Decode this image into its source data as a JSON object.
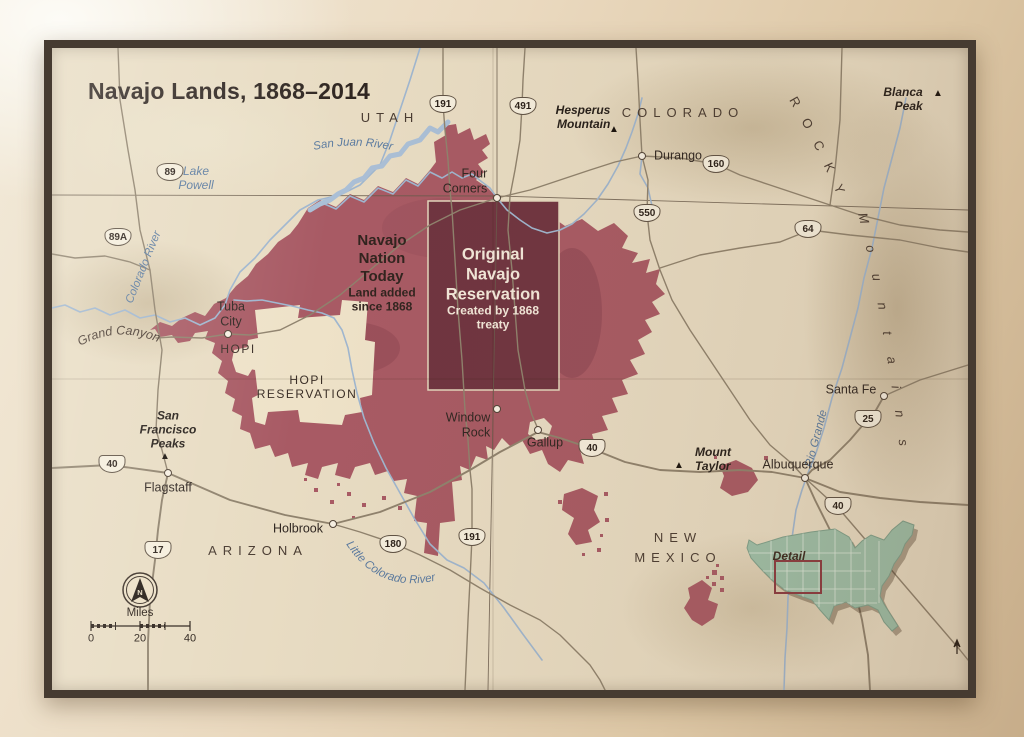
{
  "title": "Navajo Lands, 1868–2014",
  "legend": {
    "nation_title": "Navajo\nNation\nToday",
    "nation_sub": "Land added\nsince 1868",
    "original_title": "Original\nNavajo\nReservation",
    "original_sub": "Created by 1868\ntreaty"
  },
  "states": {
    "utah": "UTAH",
    "colorado": "COLORADO",
    "arizona": "ARIZONA",
    "new_mexico": "NEW\nMEXICO",
    "rocky": "ROCKY",
    "mountains": "Mountains"
  },
  "cities": {
    "four_corners": "Four\nCorners",
    "durango": "Durango",
    "tuba_city": "Tuba\nCity",
    "window_rock": "Window\nRock",
    "gallup": "Gallup",
    "holbrook": "Holbrook",
    "flagstaff": "Flagstaff",
    "albuquerque": "Albuquerque",
    "santa_fe": "Santa Fe"
  },
  "peaks": {
    "hesperus": "Hesperus\nMountain",
    "blanca": "Blanca\nPeak",
    "san_francisco": "San\nFrancisco\nPeaks",
    "mount_taylor": "Mount\nTaylor"
  },
  "water": {
    "lake_powell": "Lake\nPowell",
    "san_juan_river": "San Juan River",
    "colorado_river": "Colorado River",
    "little_colorado_river": "Little Colorado River",
    "rio_grande": "Rio Grande",
    "grand_canyon": "Grand Canyon"
  },
  "areas": {
    "hopi": "HOPI",
    "hopi_reservation": "HOPI\nRESERVATION"
  },
  "routes": {
    "us89": "89",
    "us89a": "89A",
    "us191_n": "191",
    "us491": "491",
    "us160": "160",
    "us550": "550",
    "us64": "64",
    "i25": "25",
    "i40_w": "40",
    "i40_c": "40",
    "i40_e": "40",
    "i17": "17",
    "us180": "180",
    "us191_s": "191"
  },
  "scale": {
    "label": "Miles",
    "t0": "0",
    "t20": "20",
    "t40": "40",
    "north": "N"
  },
  "inset": {
    "detail_label": "Detail"
  },
  "colors": {
    "nation": "#a85a64",
    "original": "#6f3440",
    "map_bg": "#e8dcc3",
    "hopi_fill": "#eee2c8",
    "frame": "#463b31",
    "inset_green": "#9dbfa8",
    "river": "#9fb6cf",
    "road": "#8f826d",
    "water_label": "#5b7ba0",
    "ink": "#2f2621",
    "detail_box": "#8a3a40"
  }
}
